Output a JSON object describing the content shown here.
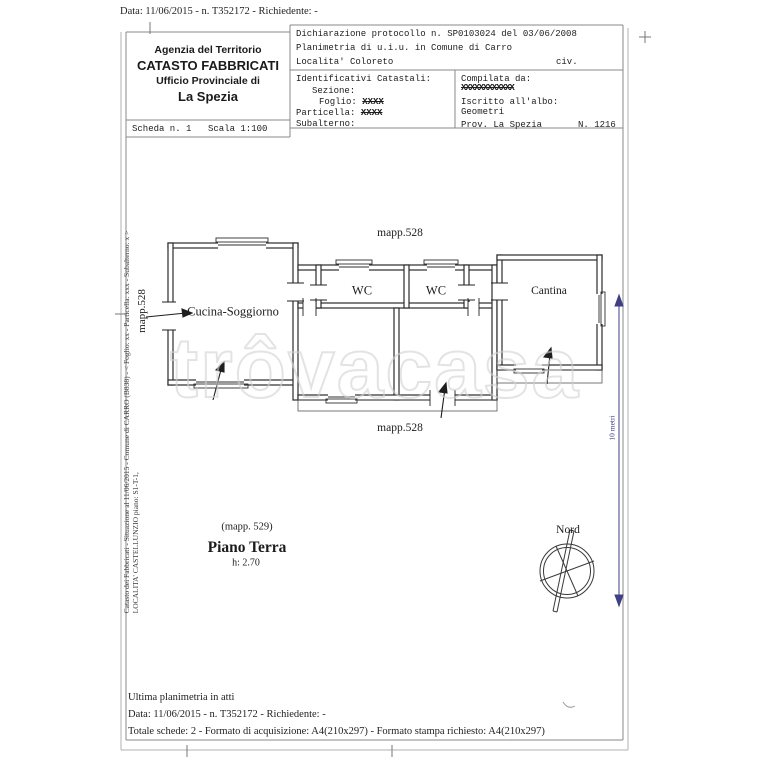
{
  "doc": {
    "top_line": "Data: 11/06/2015 - n. T352172 - Richiedente: -",
    "footer": {
      "line1": "Ultima planimetria in atti",
      "line2": "Data: 11/06/2015 - n. T352172 - Richiedente: -",
      "line3": "Totale schede: 2 - Formato di acquisizione: A4(210x297)  - Formato stampa richiesto: A4(210x297)"
    },
    "left_margin": {
      "line1": "Catasto dei Fabbricati - Situazione al 11/06/2015 - Comune di CARRO (B838) - < Foglio: xx - Particella: xxx - Subalterno: x >",
      "line2": "LOCALITA' CASTELLUNZIO piano: S1-T-1,"
    }
  },
  "header": {
    "agency": {
      "line1": "Agenzia del Territorio",
      "line2": "CATASTO FABBRICATI",
      "line3": "Ufficio Provinciale di",
      "line4": "La Spezia"
    },
    "scheda": {
      "scheda": "Scheda n. 1",
      "scala": "Scala 1:100"
    },
    "declaration": {
      "line1": "Dichiarazione protocollo n. SP0103024 del 03/06/2008",
      "line2": "Planimetria di u.i.u. in Comune di Carro",
      "line3": "Localita' Coloreto",
      "civ": "civ."
    },
    "identifiers": {
      "title": "Identificativi Catastali:",
      "sezione_label": "Sezione:",
      "foglio_label": "Foglio:",
      "foglio_value": "XXXX",
      "particella_label": "Particella:",
      "particella_value": "XXXX",
      "subalterno_label": "Subalterno:"
    },
    "compiler": {
      "label": "Compilata da:",
      "name_redacted": "XXXXXXXXXXXX",
      "albo_label": "Iscritto all'albo:",
      "albo_value": "Geometri",
      "prov": "Prov. La Spezia",
      "number": "N. 1216"
    }
  },
  "plan": {
    "map_label_top": "mapp.528",
    "map_label_bottom": "mapp.528",
    "map_label_left": "mapp.528",
    "rooms": [
      {
        "name": "Cucina-Soggiorno"
      },
      {
        "name": "WC"
      },
      {
        "name": "WC"
      },
      {
        "name": "Cantina"
      }
    ],
    "floor": {
      "mapp": "(mapp. 529)",
      "title": "Piano Terra",
      "height": "h: 2.70"
    },
    "compass_label": "Nord",
    "scale_label": "10 metri",
    "watermark": "trôvacasa"
  },
  "colors": {
    "scale_bar": "#3f3f85",
    "walls": "#2b2b2b",
    "frame": "#8a8a8a",
    "watermark": "#d2d2d2"
  }
}
